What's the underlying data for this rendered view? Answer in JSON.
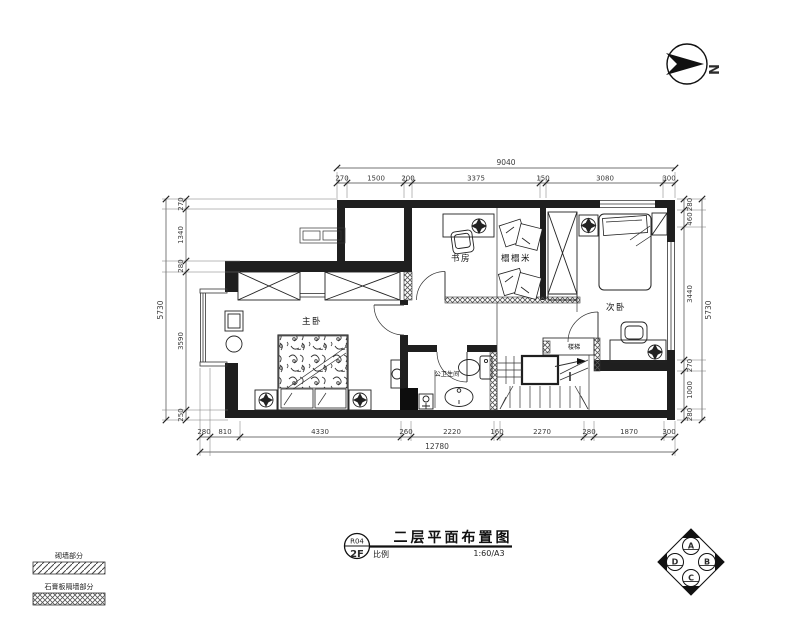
{
  "meta": {
    "title": "二层平面布置图",
    "drawing_number": "R04",
    "floor": "2F",
    "scale_label": "比例",
    "scale_value": "1:60/A3",
    "north_label": "N"
  },
  "rooms": {
    "master_bedroom": "主卧",
    "study": "书房",
    "tatami": "榻榻米",
    "second_bedroom": "次卧",
    "bathroom": "公卫生间",
    "stairs": "楼梯"
  },
  "legend": {
    "brick_wall": "砌墙部分",
    "gypsum_wall": "石膏板隔墙部分"
  },
  "elevation_marker": {
    "top": "A",
    "right": "B",
    "bottom": "C",
    "left": "D"
  },
  "dimensions": {
    "top": {
      "total": "9040",
      "segments": [
        "270",
        "1500",
        "200",
        "3375",
        "150",
        "3080",
        "300"
      ]
    },
    "left": {
      "total": "5730",
      "segments": [
        "270",
        "1340",
        "280",
        "3590",
        "250"
      ]
    },
    "right": {
      "total": "5730",
      "segments": [
        "280",
        "460",
        "3440",
        "270",
        "1000",
        "280"
      ]
    },
    "bottom": {
      "total": "12780",
      "segments": [
        "280",
        "810",
        "4330",
        "260",
        "2220",
        "160",
        "2270",
        "280",
        "1870",
        "300"
      ]
    }
  }
}
